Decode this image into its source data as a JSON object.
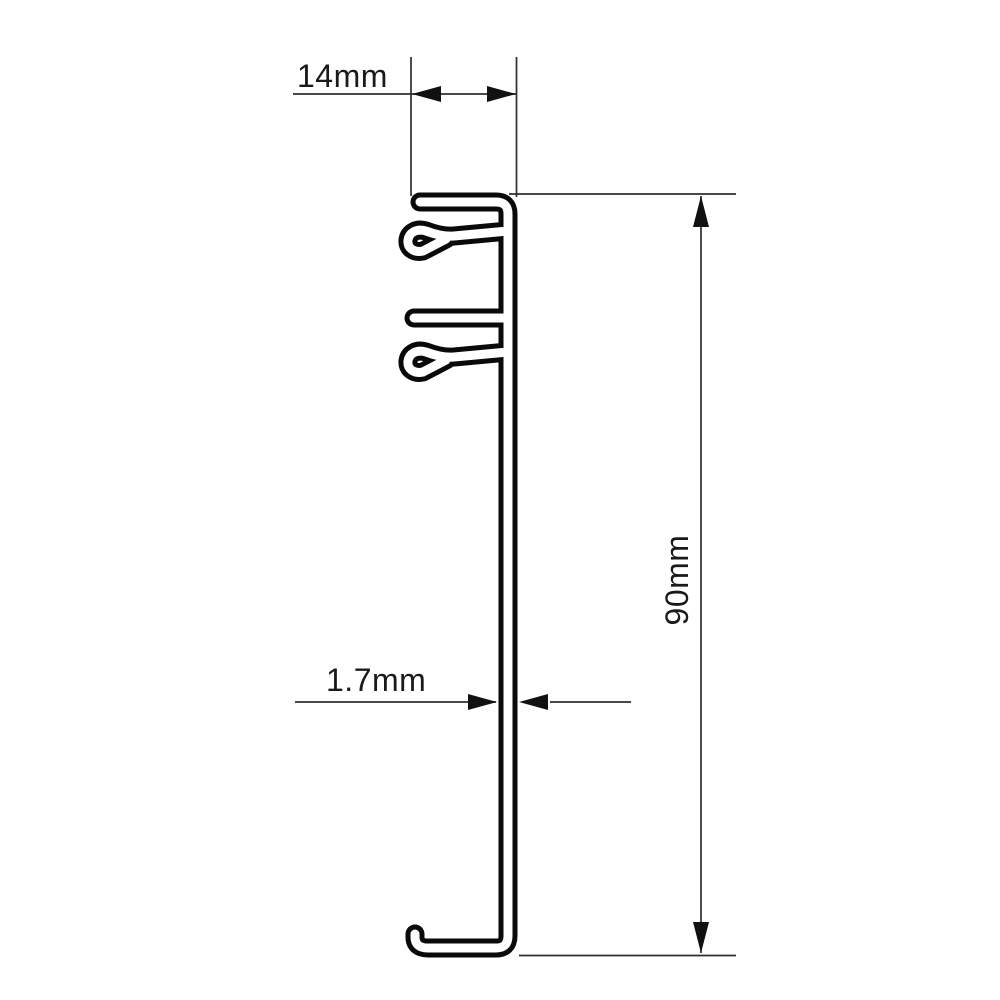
{
  "diagram": {
    "type": "technical-drawing-profile-cross-section",
    "background_color": "#ffffff",
    "profile_outline_color": "#0a0a0a",
    "dimension_line_color": "#2e2e2e",
    "text_color": "#1a1a1a",
    "dimensions": {
      "top_width": {
        "label": "14mm",
        "value": 14,
        "unit": "mm",
        "orientation": "horizontal",
        "location": "top flange width"
      },
      "overall_height": {
        "label": "90mm",
        "value": 90,
        "unit": "mm",
        "orientation": "vertical",
        "location": "right side overall height"
      },
      "wall_thickness": {
        "label": "1.7mm",
        "value": 1.7,
        "unit": "mm",
        "orientation": "horizontal",
        "location": "main wall material thickness"
      }
    }
  }
}
